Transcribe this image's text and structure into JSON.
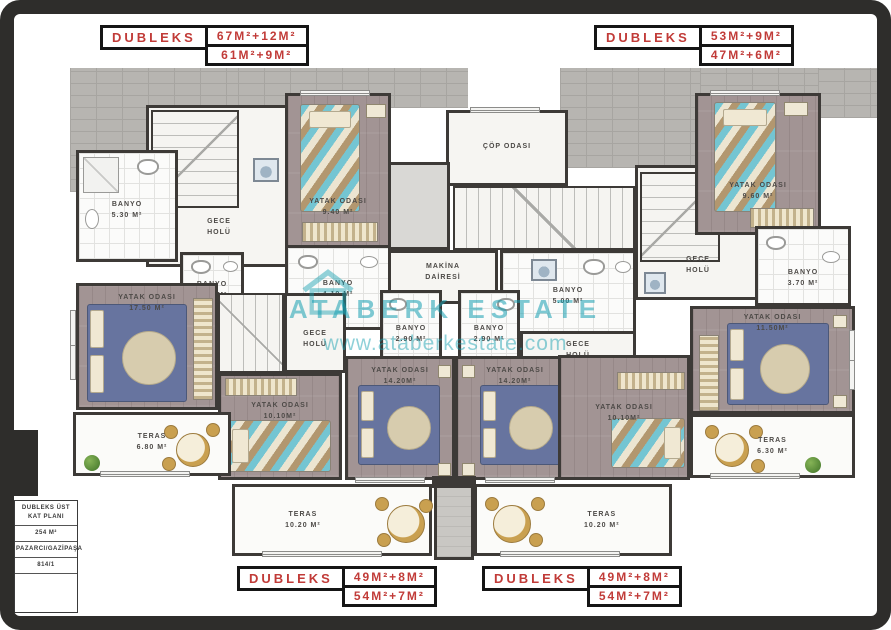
{
  "plan": {
    "type": "floor-plan",
    "info_box": {
      "title_line1": "DUBLEKS ÜST",
      "title_line2": "KAT PLANI",
      "total_area": "254 M²",
      "location": "PAZARCI/GAZİPAŞA",
      "plot_number": "814/1"
    }
  },
  "badges": {
    "text_color": "#c13b38",
    "top_left": {
      "name_label": "DUBLEKS",
      "value1": "67M²+12M²",
      "value2": "61M²+9M²"
    },
    "top_right": {
      "name_label": "DUBLEKS",
      "value1": "53M²+9M²",
      "value2": "47M²+6M²"
    },
    "bottom_left": {
      "name_label": "DUBLEKS",
      "value1": "49M²+8M²",
      "value2": "54M²+7M²"
    },
    "bottom_right": {
      "name_label": "DUBLEKS",
      "value1": "49M²+8M²",
      "value2": "54M²+7M²"
    }
  },
  "watermark": {
    "brand": "ATABERK ESTATE",
    "url": "www.ataberkestate.com",
    "color": "#15a0b0",
    "icon": "house-icon"
  },
  "rooms": [
    {
      "id": "banyo-530",
      "line1": "BANYO",
      "line2": "5.30 M²"
    },
    {
      "id": "gece-holu-left-top",
      "line1": "GECE",
      "line2": "HOLÜ"
    },
    {
      "id": "yatak-940",
      "line1": "YATAK ODASI",
      "line2": "9.40 M²"
    },
    {
      "id": "banyo-340",
      "line1": "BANYO",
      "line2": "3.40 M²"
    },
    {
      "id": "banyo-410",
      "line1": "BANYO",
      "line2": "4.10 M²"
    },
    {
      "id": "yatak-1750",
      "line1": "YATAK ODASI",
      "line2": "17.50 M²"
    },
    {
      "id": "gece-holu-left-mid",
      "line1": "GECE",
      "line2": "HOLÜ"
    },
    {
      "id": "banyo-290-left",
      "line1": "BANYO",
      "line2": "2.90 M²"
    },
    {
      "id": "yatak-1010-left",
      "line1": "YATAK ODASI",
      "line2": "10.10M²"
    },
    {
      "id": "yatak-1420-left",
      "line1": "YATAK ODASI",
      "line2": "14.20M²"
    },
    {
      "id": "teras-680",
      "line1": "TERAS",
      "line2": "6.80 M²"
    },
    {
      "id": "teras-1020-left",
      "line1": "TERAS",
      "line2": "10.20 M²"
    },
    {
      "id": "cop-odasi",
      "line1": "ÇÖP ODASI",
      "line2": ""
    },
    {
      "id": "makina-dairesi",
      "line1": "MAKİNA",
      "line2": "DAİRESİ"
    },
    {
      "id": "banyo-500",
      "line1": "BANYO",
      "line2": "5.00 M²"
    },
    {
      "id": "yatak-960",
      "line1": "YATAK ODASI",
      "line2": "9.60 M²"
    },
    {
      "id": "gece-holu-right-top",
      "line1": "GECE",
      "line2": "HOLÜ"
    },
    {
      "id": "banyo-370",
      "line1": "BANYO",
      "line2": "3.70 M²"
    },
    {
      "id": "yatak-1150",
      "line1": "YATAK ODASI",
      "line2": "11.50M²"
    },
    {
      "id": "banyo-290-right",
      "line1": "BANYO",
      "line2": "2.90 M²"
    },
    {
      "id": "gece-holu-right-mid",
      "line1": "GECE",
      "line2": "HOLÜ"
    },
    {
      "id": "yatak-1010-right",
      "line1": "YATAK ODASI",
      "line2": "10.10M²"
    },
    {
      "id": "yatak-1420-right",
      "line1": "YATAK ODASI",
      "line2": "14.20M²"
    },
    {
      "id": "teras-630",
      "line1": "TERAS",
      "line2": "6.30 M²"
    },
    {
      "id": "teras-1020-right",
      "line1": "TERAS",
      "line2": "10.20 M²"
    }
  ],
  "furniture_icons": [
    "single-bed",
    "double-bed",
    "wardrobe",
    "nightstand",
    "round-table",
    "chair",
    "plant",
    "toilet",
    "sink",
    "shower",
    "washing-machine",
    "stair-treads",
    "window"
  ],
  "colors": {
    "frame": "#2e2d2b",
    "walls": "#3d3a37",
    "wood_floor": "#a29494",
    "brick": "#b7b5b1",
    "badge_text": "#c13b38",
    "watermark": "#15a0b0"
  }
}
